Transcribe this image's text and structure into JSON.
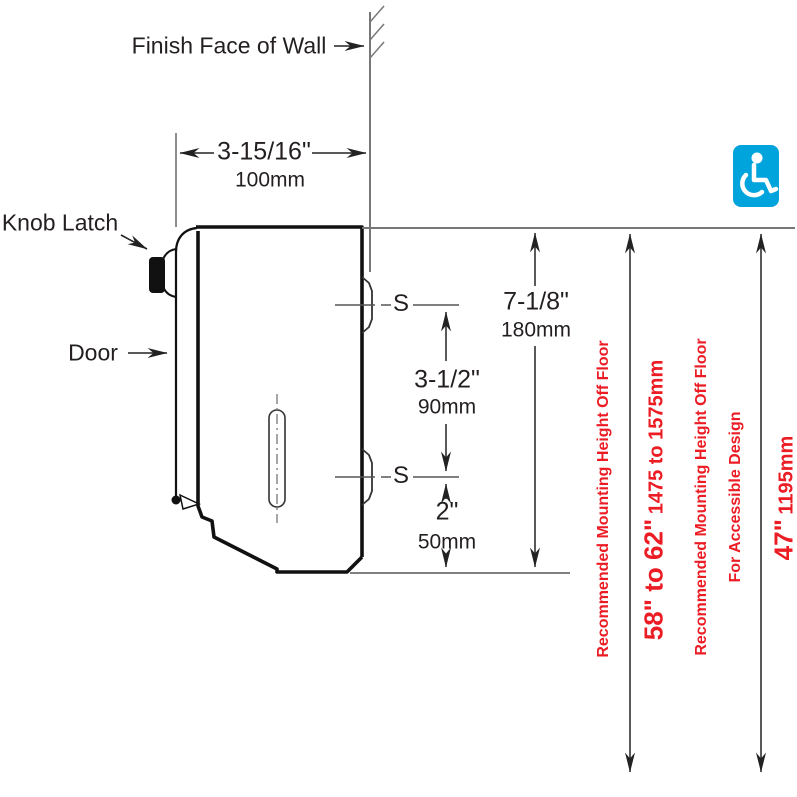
{
  "labels": {
    "finish_face": "Finish Face of Wall",
    "knob_latch": "Knob Latch",
    "door": "Door",
    "screw_upper": "S",
    "screw_lower": "S"
  },
  "dims": {
    "depth_in": "3-15/16\"",
    "depth_mm": "100mm",
    "offset_in": "7-1/8\"",
    "offset_mm": "180mm",
    "spacing_in": "3-1/2\"",
    "spacing_mm": "90mm",
    "bottom_in": "2\"",
    "bottom_mm": "50mm"
  },
  "notes": {
    "standard": {
      "label": "Recommended Mounting Height Off Floor",
      "value_in": "58\" to 62\"",
      "value_mm": "1475 to 1575mm"
    },
    "accessible": {
      "label1": "Recommended Mounting Height Off Floor",
      "label2": "For Accessible Design",
      "value_in": "47\"",
      "value_mm": "1195mm"
    }
  },
  "icons": {
    "accessibility": "wheelchair-accessibility-icon"
  },
  "colors": {
    "note_red": "#ec1c24",
    "icon_blue": "#00a4dc",
    "line_black": "#222222",
    "line_gray": "#777777"
  }
}
